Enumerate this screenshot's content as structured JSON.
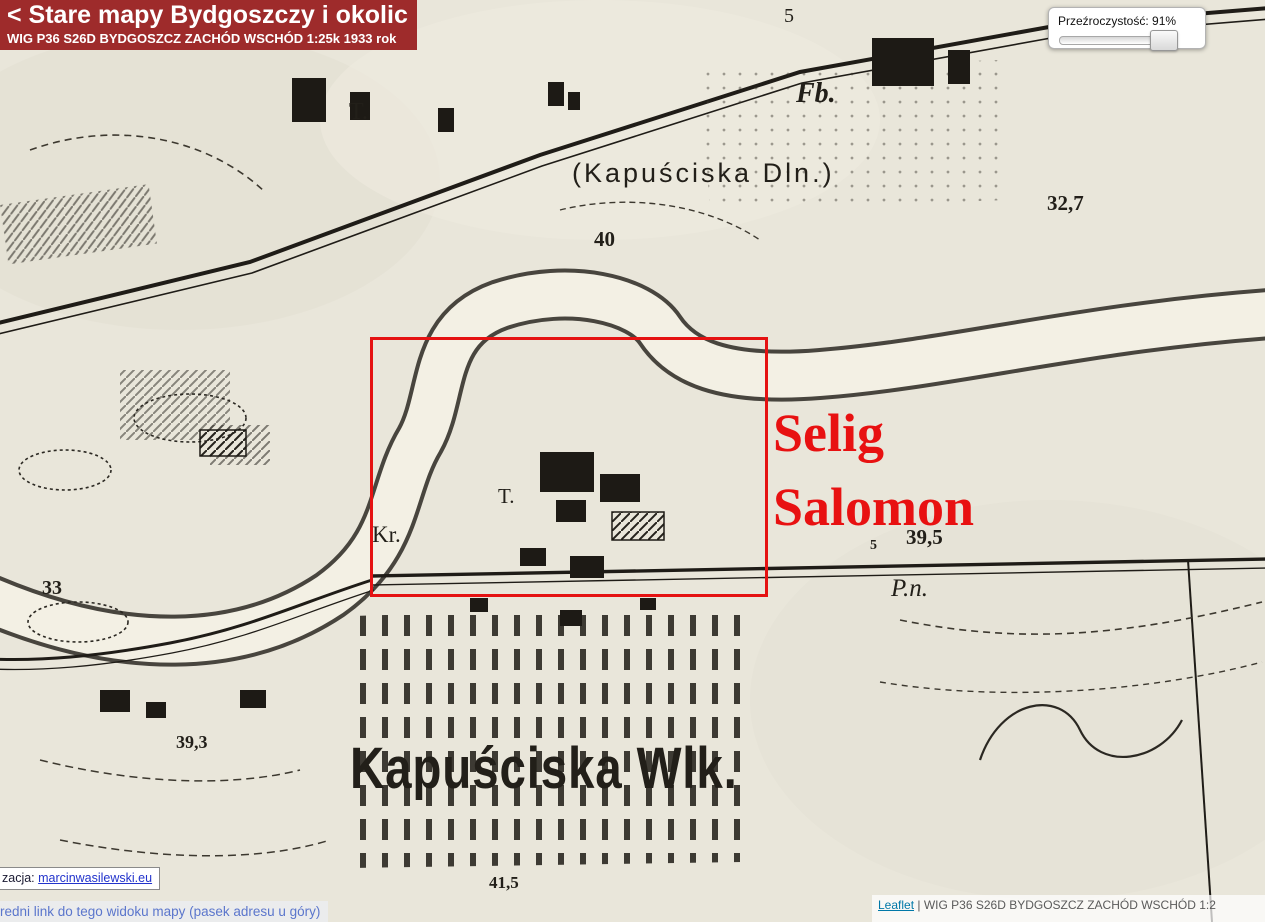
{
  "header": {
    "title": "< Stare mapy Bydgoszczy i okolic",
    "subtitle": "WIG P36 S26D BYDGOSZCZ ZACHÓD WSCHÓD 1:25k 1933 rok",
    "bg_color": "#9e2b2b"
  },
  "opacity_control": {
    "label": "Przeźroczystość: 91%",
    "value_percent": 91
  },
  "annotation": {
    "line1": "Selig",
    "line2": "Salomon",
    "color": "#e81111",
    "rect": {
      "x": 370,
      "y": 337,
      "w": 398,
      "h": 260
    },
    "rect_color": "#e51212"
  },
  "map_labels": [
    {
      "text": "5",
      "x": 784,
      "y": 6,
      "size": 20,
      "serif": true
    },
    {
      "text": "T.",
      "x": 349,
      "y": 100,
      "size": 24,
      "serif": true
    },
    {
      "text": "Fb.",
      "x": 796,
      "y": 80,
      "size": 28,
      "serif": true,
      "italic": true,
      "bold": true
    },
    {
      "text": "(Kapuściska Dln.)",
      "x": 572,
      "y": 160,
      "size": 27,
      "spacing": 3
    },
    {
      "text": "32,7",
      "x": 1047,
      "y": 193,
      "size": 21,
      "serif": true,
      "bold": true
    },
    {
      "text": "40",
      "x": 594,
      "y": 229,
      "size": 21,
      "serif": true,
      "bold": true
    },
    {
      "text": "33",
      "x": 42,
      "y": 578,
      "size": 20,
      "serif": true,
      "bold": true
    },
    {
      "text": "Kr.",
      "x": 372,
      "y": 523,
      "size": 23,
      "serif": true
    },
    {
      "text": "T.",
      "x": 498,
      "y": 486,
      "size": 21,
      "serif": true
    },
    {
      "text": "5",
      "x": 870,
      "y": 539,
      "size": 14,
      "serif": true,
      "bold": true
    },
    {
      "text": "39,5",
      "x": 906,
      "y": 527,
      "size": 21,
      "serif": true,
      "bold": true
    },
    {
      "text": "P.n.",
      "x": 891,
      "y": 576,
      "size": 25,
      "serif": true,
      "italic": true
    },
    {
      "text": "39,3",
      "x": 176,
      "y": 733,
      "size": 18,
      "serif": true,
      "bold": true
    },
    {
      "text": "Kapuściska Wlk.",
      "x": 350,
      "y": 740,
      "size": 58,
      "bold": true,
      "scale_x": 0.82,
      "spacing": 1
    },
    {
      "text": "41,5",
      "x": 489,
      "y": 874,
      "size": 17,
      "serif": true,
      "bold": true
    }
  ],
  "footer_left": {
    "prefix": "zacja: ",
    "link": "marcinwasilewski.eu",
    "link_color": "#2233cc"
  },
  "footer_bottom": {
    "text": "redni link do tego widoku mapy (pasek adresu u góry)",
    "text_color": "#5b76cc"
  },
  "attribution": {
    "link": "Leaflet",
    "separator": " | ",
    "text": "WIG P36 S26D BYDGOSZCZ ZACHÓD WSCHÓD 1:2",
    "link_color": "#0078a8"
  }
}
